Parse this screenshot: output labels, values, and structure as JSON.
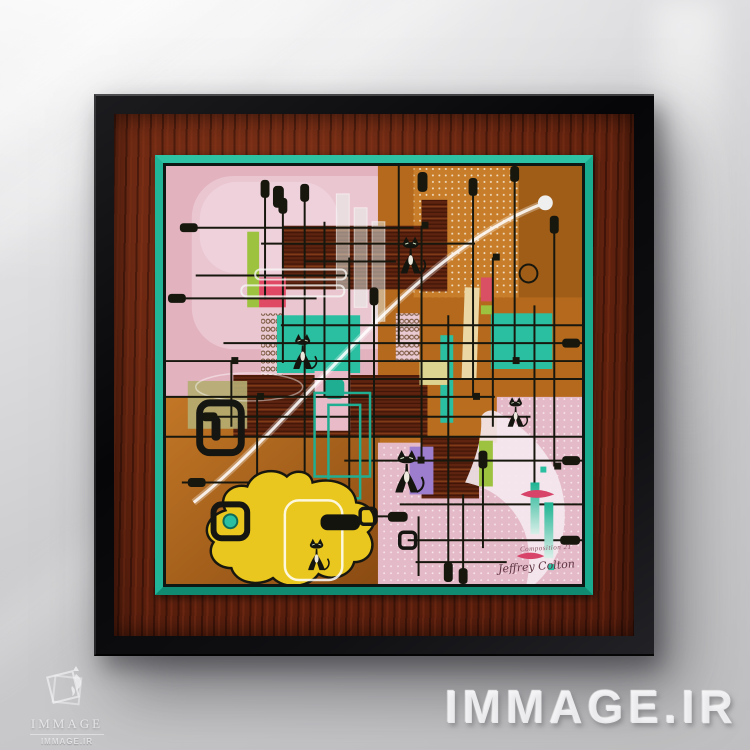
{
  "scene": {
    "type": "photograph",
    "description": "Mid-century modern atomic-age abstract painting with black cats, framed in glossy black and mahogany wood with a teal liner, hanging on a light gray wall lit by diagonal window light"
  },
  "frame": {
    "outer_color": "#0b0b0d",
    "mat_wood_color": "#5e2212",
    "liner_color": "#1aab8e"
  },
  "artwork": {
    "style": "Mid-century modern abstract grid with atomic cats, amoeba blob and boomerang shapes",
    "inscription": "Composition 21",
    "signature": "Jeffrey Colton",
    "cats_count": 5,
    "palette": {
      "pink": "#e2b2bf",
      "light_pink": "#eac7d2",
      "orange": "#b4691c",
      "dark_orange": "#a05d17",
      "wood_brown": "#5f2410",
      "teal": "#2bbfa1",
      "yellow": "#e9c71e",
      "lime": "#9cc23f",
      "crimson": "#e04964",
      "cream": "#ead7a5",
      "purple": "#9d7dce",
      "line_black": "#17170e",
      "white": "#f4eef0"
    }
  },
  "watermark": {
    "text": "IMMAGE.IR",
    "color": "#f0f0f2"
  },
  "logo": {
    "name": "IMMAGE",
    "site": "IMMAGE.IR"
  }
}
